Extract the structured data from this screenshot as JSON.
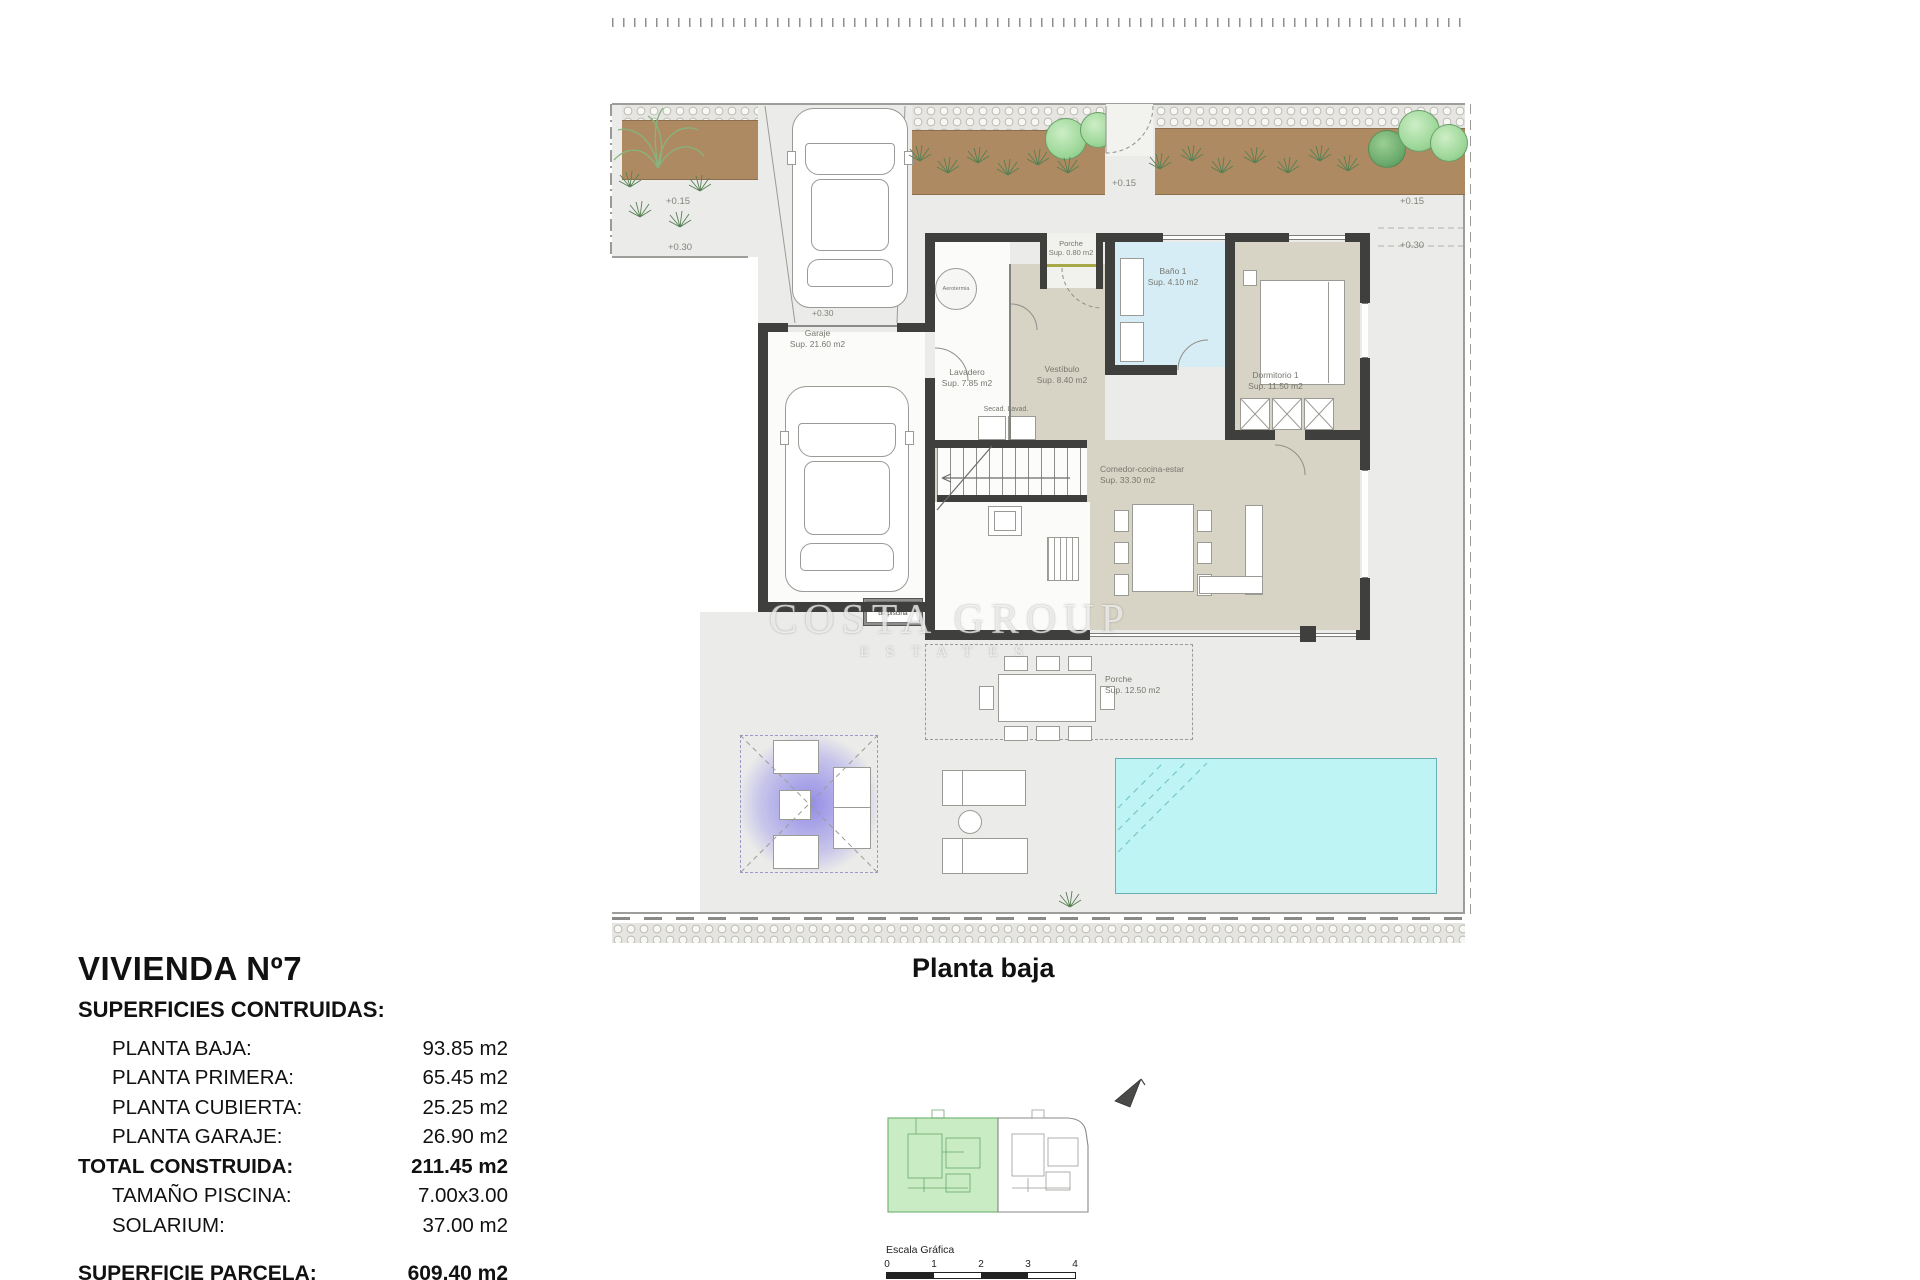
{
  "watermark": {
    "line1": "COSTA GROUP",
    "line2": "ESTATES"
  },
  "plan": {
    "caption": "Planta baja",
    "rooms": {
      "garaje": {
        "name": "Garaje",
        "sup": "Sup. 21.60 m2"
      },
      "porche_ent": {
        "name": "Porche",
        "sup": "Sup. 0.80 m2"
      },
      "bano1": {
        "name": "Baño 1",
        "sup": "Sup. 4.10 m2"
      },
      "vestibulo": {
        "name": "Vestíbulo",
        "sup": "Sup. 8.40 m2"
      },
      "dormitorio1": {
        "name": "Dormitorio 1",
        "sup": "Sup. 11.50 m2"
      },
      "lavadero": {
        "name": "Lavadero",
        "sup": "Sup. 7.85 m2"
      },
      "secadero": {
        "name": "Secad.  Lavad."
      },
      "comedor": {
        "name": "Comedor-cocina-estar",
        "sup": "Sup. 33.30 m2"
      },
      "porche_tras": {
        "name": "Porche",
        "sup": "Sup. 12.50 m2"
      },
      "depuradora": {
        "line1": "Depuradora",
        "line2": "de piscina"
      },
      "aerotermia": {
        "name": "Aerotermia"
      }
    },
    "levels": {
      "p015": "+0.15",
      "p030": "+0.30"
    }
  },
  "summary": {
    "title": "VIVIENDA Nº7",
    "subtitle": "SUPERFICIES CONTRUIDAS:",
    "rows": [
      {
        "label": "PLANTA BAJA:",
        "value": "93.85 m2",
        "bold": false
      },
      {
        "label": "PLANTA PRIMERA:",
        "value": "65.45 m2",
        "bold": false
      },
      {
        "label": "PLANTA CUBIERTA:",
        "value": "25.25 m2",
        "bold": false
      },
      {
        "label": "PLANTA GARAJE:",
        "value": "26.90 m2",
        "bold": false
      },
      {
        "label": "TOTAL CONSTRUIDA:",
        "value": "211.45 m2",
        "bold": true
      },
      {
        "label": "TAMAÑO PISCINA:",
        "value": "7.00x3.00",
        "bold": false
      },
      {
        "label": "SOLARIUM:",
        "value": "37.00 m2",
        "bold": false
      }
    ],
    "parcela": {
      "label": "SUPERFICIE PARCELA:",
      "value": "609.40 m2"
    }
  },
  "scale": {
    "label": "Escala Gráfica",
    "ticks": [
      "0",
      "1",
      "2",
      "3",
      "4"
    ]
  },
  "colors": {
    "wall": "#3f3f3d",
    "ground": "#ebebe9",
    "room_beige": "#d8d4c5",
    "bath_blue": "#d7edf6",
    "pool": "#bff4f5",
    "planting": "#ae8a62",
    "keyplan_highlight": "#c9ecc4",
    "pergola_glow": "#564ce4"
  }
}
